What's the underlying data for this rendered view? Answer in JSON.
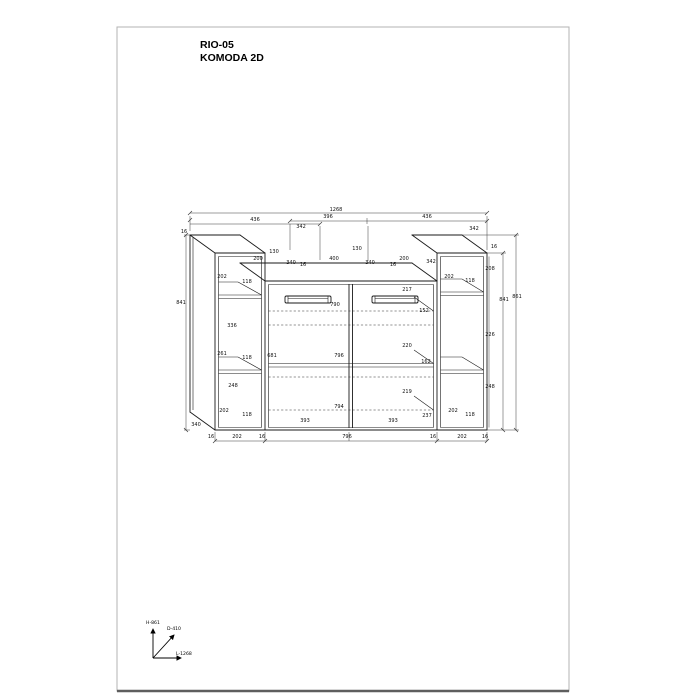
{
  "page": {
    "title_line1": "RIO-05",
    "title_line2": "KOMODA 2D"
  },
  "axes": {
    "height_label": "H-861",
    "depth_label": "D-410",
    "length_label": "L-1268"
  },
  "drawing": {
    "description": "technical dimension drawing of 2-door commode with two open side towers",
    "dimensions": [
      {
        "t": "1268",
        "x": 336,
        "y": 211
      },
      {
        "t": "436",
        "x": 255,
        "y": 221
      },
      {
        "t": "396",
        "x": 328,
        "y": 218
      },
      {
        "t": "436",
        "x": 427,
        "y": 218
      },
      {
        "t": "16",
        "x": 184,
        "y": 233
      },
      {
        "t": "342",
        "x": 301,
        "y": 228
      },
      {
        "t": "342",
        "x": 474,
        "y": 230
      },
      {
        "t": "200",
        "x": 258,
        "y": 260
      },
      {
        "t": "130",
        "x": 274,
        "y": 253
      },
      {
        "t": "340",
        "x": 291,
        "y": 264
      },
      {
        "t": "16",
        "x": 303,
        "y": 266
      },
      {
        "t": "400",
        "x": 334,
        "y": 260
      },
      {
        "t": "130",
        "x": 357,
        "y": 250
      },
      {
        "t": "340",
        "x": 370,
        "y": 264
      },
      {
        "t": "16",
        "x": 393,
        "y": 266
      },
      {
        "t": "200",
        "x": 404,
        "y": 260
      },
      {
        "t": "342",
        "x": 431,
        "y": 263
      },
      {
        "t": "841",
        "x": 181,
        "y": 304
      },
      {
        "t": "202",
        "x": 222,
        "y": 278
      },
      {
        "t": "118",
        "x": 247,
        "y": 283
      },
      {
        "t": "336",
        "x": 232,
        "y": 327
      },
      {
        "t": "261",
        "x": 222,
        "y": 355
      },
      {
        "t": "118",
        "x": 247,
        "y": 359
      },
      {
        "t": "248",
        "x": 233,
        "y": 387
      },
      {
        "t": "202",
        "x": 224,
        "y": 412
      },
      {
        "t": "118",
        "x": 247,
        "y": 416
      },
      {
        "t": "340",
        "x": 196,
        "y": 426
      },
      {
        "t": "16",
        "x": 494,
        "y": 248
      },
      {
        "t": "208",
        "x": 490,
        "y": 270
      },
      {
        "t": "202",
        "x": 449,
        "y": 278
      },
      {
        "t": "118",
        "x": 470,
        "y": 282
      },
      {
        "t": "226",
        "x": 490,
        "y": 336
      },
      {
        "t": "841",
        "x": 504,
        "y": 301
      },
      {
        "t": "861",
        "x": 517,
        "y": 298
      },
      {
        "t": "248",
        "x": 490,
        "y": 388
      },
      {
        "t": "202",
        "x": 453,
        "y": 412
      },
      {
        "t": "118",
        "x": 470,
        "y": 416
      },
      {
        "t": "217",
        "x": 407,
        "y": 291
      },
      {
        "t": "790",
        "x": 335,
        "y": 306
      },
      {
        "t": "152",
        "x": 424,
        "y": 312
      },
      {
        "t": "220",
        "x": 407,
        "y": 347
      },
      {
        "t": "681",
        "x": 272,
        "y": 357
      },
      {
        "t": "796",
        "x": 339,
        "y": 357
      },
      {
        "t": "162",
        "x": 426,
        "y": 363
      },
      {
        "t": "219",
        "x": 407,
        "y": 393
      },
      {
        "t": "794",
        "x": 339,
        "y": 408
      },
      {
        "t": "393",
        "x": 305,
        "y": 422
      },
      {
        "t": "393",
        "x": 393,
        "y": 422
      },
      {
        "t": "237",
        "x": 427,
        "y": 417
      },
      {
        "t": "16",
        "x": 211,
        "y": 438
      },
      {
        "t": "202",
        "x": 237,
        "y": 438
      },
      {
        "t": "16",
        "x": 262,
        "y": 438
      },
      {
        "t": "796",
        "x": 347,
        "y": 438
      },
      {
        "t": "16",
        "x": 433,
        "y": 438
      },
      {
        "t": "202",
        "x": 462,
        "y": 438
      },
      {
        "t": "16",
        "x": 485,
        "y": 438
      }
    ]
  }
}
